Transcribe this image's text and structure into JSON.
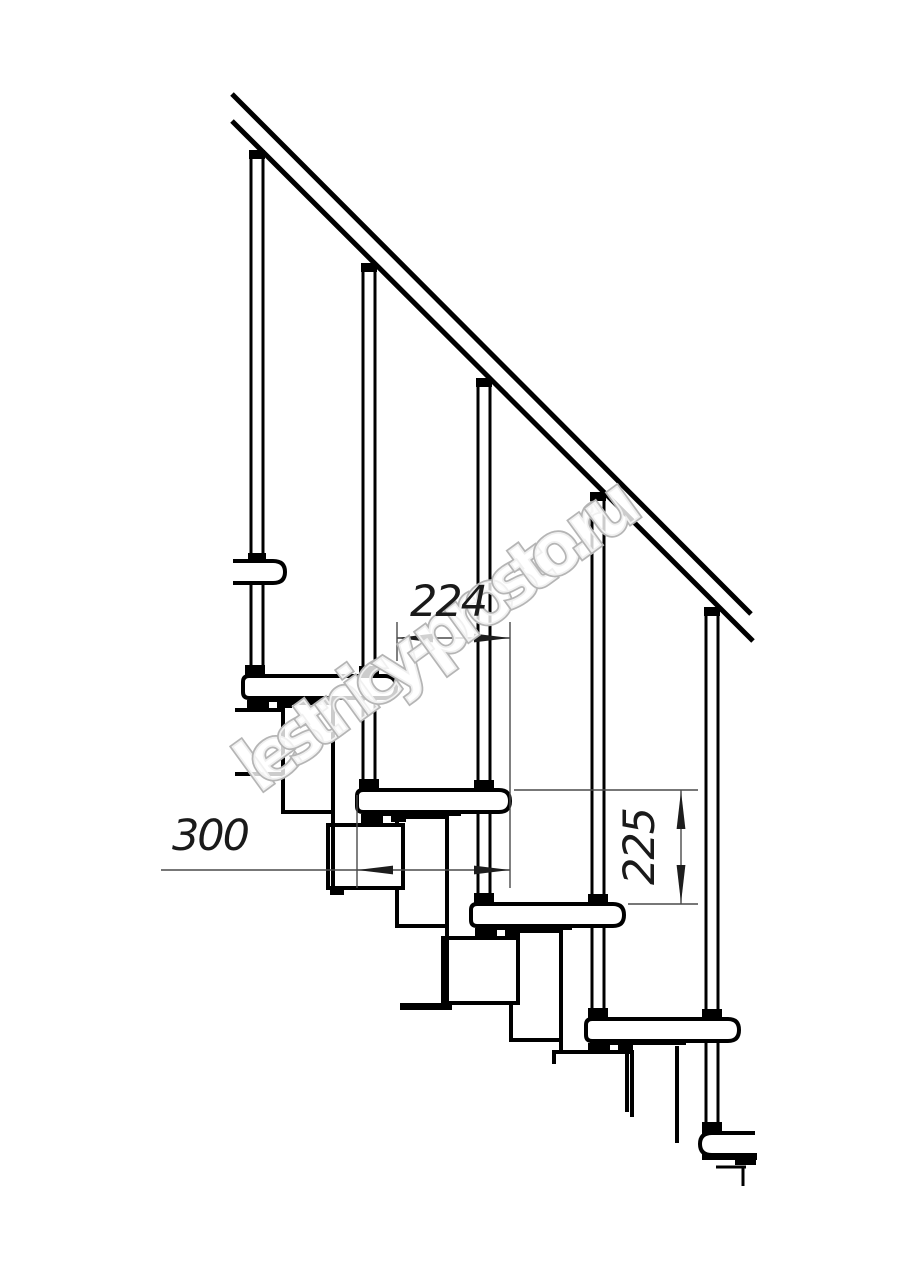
{
  "drawing": {
    "dimension_labels": {
      "step_run": "224",
      "tread_length": "300",
      "step_rise": "225"
    },
    "watermark_text": "lestnicy-prosto.ru",
    "colors": {
      "outline": "#000000",
      "dimension_line": "#4a4a4a",
      "dimension_text": "#1a1a1a",
      "arrow": "#1d1d1d",
      "watermark_outline": "#b5b5b5",
      "background": "#ffffff"
    }
  }
}
